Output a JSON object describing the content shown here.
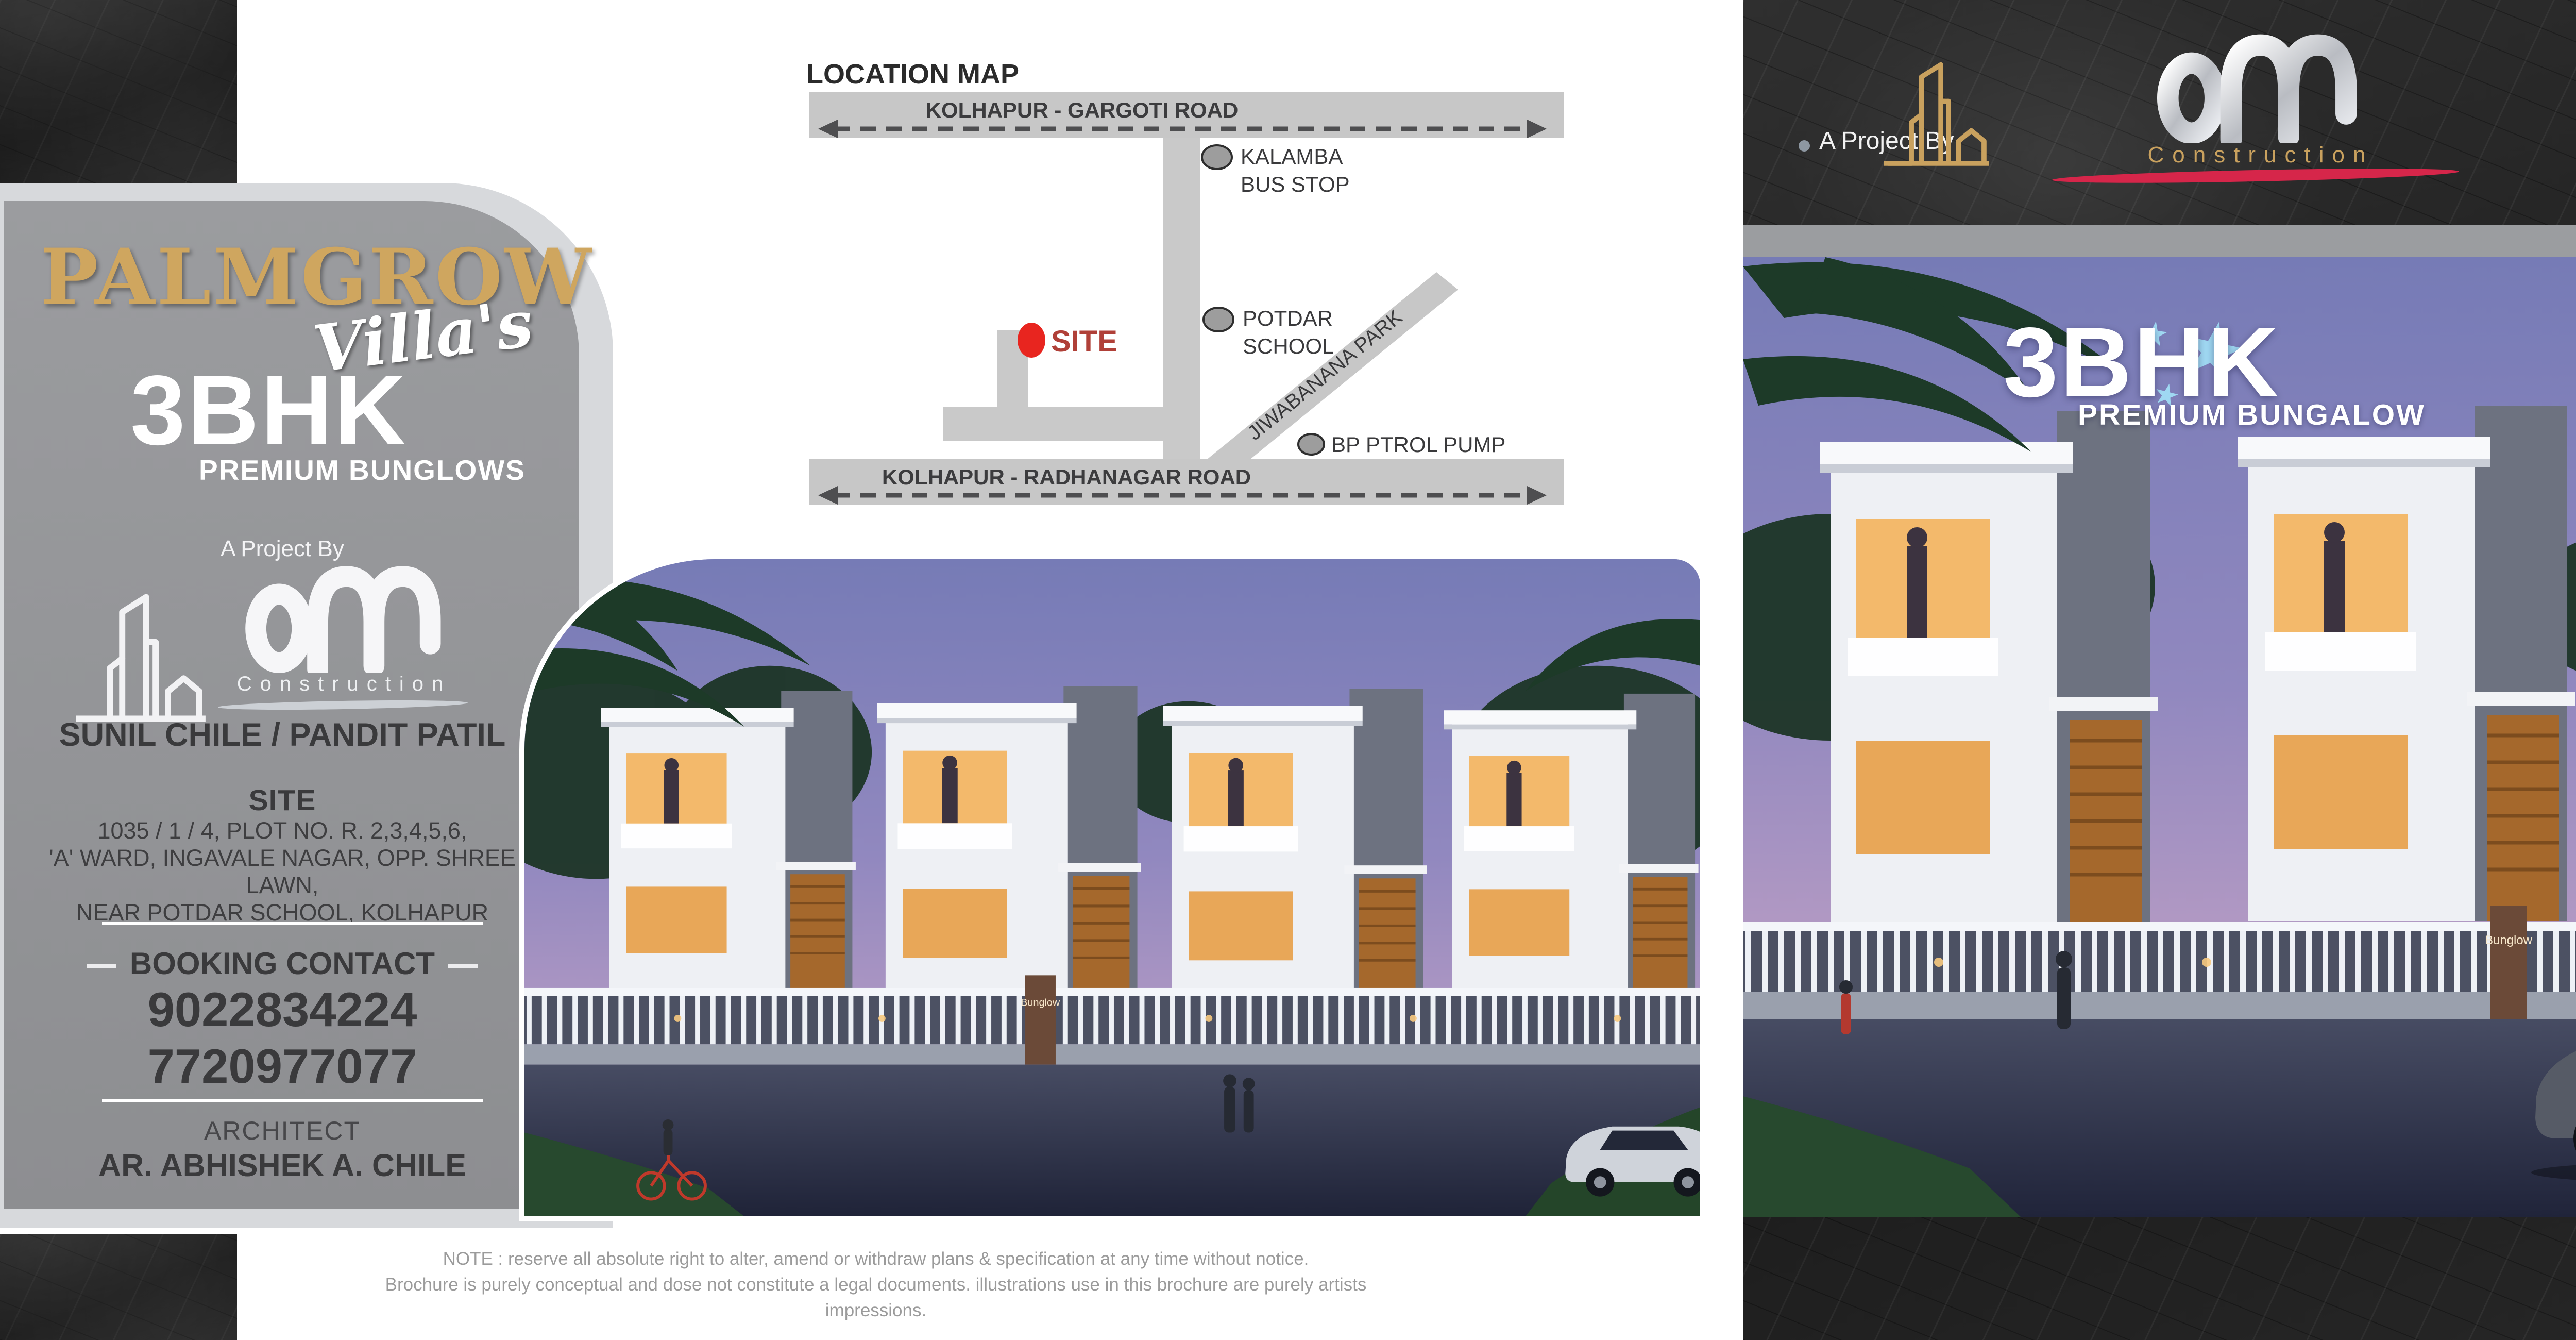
{
  "left_panel": {
    "brand": "PALMGROW",
    "brand_script": "Villa's",
    "unit_type": "3BHK",
    "unit_subtitle": "PREMIUM BUNGLOWS",
    "project_by_label": "A Project By",
    "builder_subtitle": "Construction",
    "developers": "SUNIL CHILE / PANDIT PATIL",
    "site_heading": "SITE",
    "site_address_line1": "1035 / 1 / 4, PLOT NO. R. 2,3,4,5,6,",
    "site_address_line2": "'A' WARD, INGAVALE NAGAR, OPP. SHREE LAWN,",
    "site_address_line3": "NEAR POTDAR SCHOOL, KOLHAPUR",
    "booking_heading": "BOOKING CONTACT",
    "phone_primary": "9022834224",
    "phone_secondary": "7720977077",
    "architect_heading": "ARCHITECT",
    "architect_name": "AR. ABHISHEK A. CHILE"
  },
  "location_map": {
    "title": "LOCATION MAP",
    "top_road": "KOLHAPUR - GARGOTI ROAD",
    "bottom_road": "KOLHAPUR - RADHANAGAR ROAD",
    "site_marker": "SITE",
    "kalamba_line1": "KALAMBA",
    "kalamba_line2": "BUS STOP",
    "potdar_line1": "POTDAR",
    "potdar_line2": "SCHOOL",
    "park_road": "JIWABANANA PARK",
    "petrol_pump": "BP PTROL PUMP"
  },
  "note": {
    "line1": "NOTE : reserve all absolute right to alter, amend or withdraw plans & specification at any time without notice.",
    "line2": "Brochure is purely conceptual and dose not constitute a legal documents. illustrations use in this brochure are purely artists impressions."
  },
  "right_panel": {
    "project_by_label": "A Project By",
    "builder_subtitle": "Construction",
    "brand": "PALMGROW",
    "brand_script": "Villa's",
    "overlay_title": "3BHK",
    "overlay_subtitle": "PREMIUM BUNGALOW",
    "gate_label": "Bunglow",
    "credai_member": "MEMBER OF",
    "credai_name": "CREDAI",
    "credai_city": "KOLHAPUR"
  },
  "colors": {
    "gold": "#cfa65f",
    "logo_gold": "#c9a15e",
    "silver": "#e9eaec",
    "card_gray": "#949699",
    "card_border": "#d7d9dc",
    "dark_text": "#3a3a3c",
    "accent_red": "#d6264a",
    "site_red": "#e8251f",
    "credai_green": "#0e6a3c",
    "star_blue": "#9fd8f2",
    "map_road": "#c7c7c7",
    "note_gray": "#9b9b9b"
  }
}
